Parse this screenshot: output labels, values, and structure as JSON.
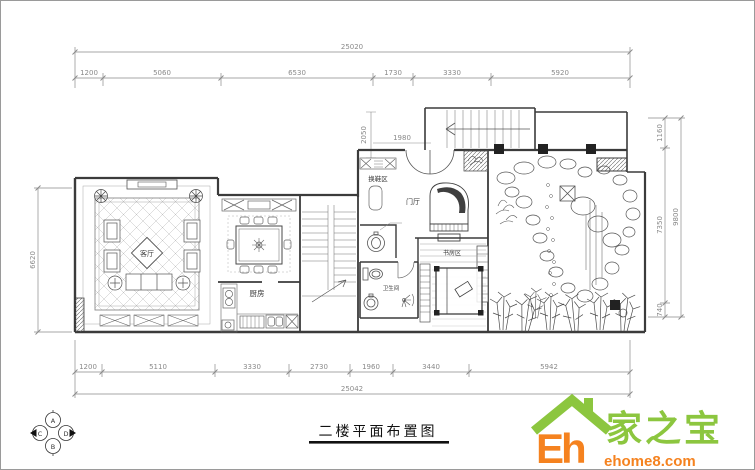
{
  "title": "二楼平面布置图",
  "dims": {
    "top": {
      "total": "25020",
      "segments": [
        "1200",
        "5060",
        "6530",
        "1730",
        "3330",
        "5920"
      ]
    },
    "bottom": {
      "total": "25042",
      "segments": [
        "1200",
        "5110",
        "3330",
        "2730",
        "1960",
        "3440",
        "5942"
      ]
    },
    "right": {
      "total": "9800",
      "segments": [
        "1160",
        "7350",
        "740"
      ]
    },
    "left": {
      "segments": [
        "6620"
      ]
    },
    "inner": {
      "v": "2050",
      "h": "1980"
    }
  },
  "rooms": {
    "living": "客厅",
    "kitchen": "厨房",
    "shoe": "换鞋区",
    "foyer": "门厅",
    "study": "书房区",
    "bath": "卫生间"
  },
  "compass": {
    "a": "A",
    "b": "B",
    "c": "C",
    "d": "D"
  },
  "logo": {
    "eh": "Eh",
    "name": "家之宝",
    "site": "ehome8.com"
  },
  "colors": {
    "logo_green": "#8cc63f",
    "logo_orange": "#f5821f",
    "wall": "#3b3b3b",
    "dim": "#8a8a8a"
  }
}
